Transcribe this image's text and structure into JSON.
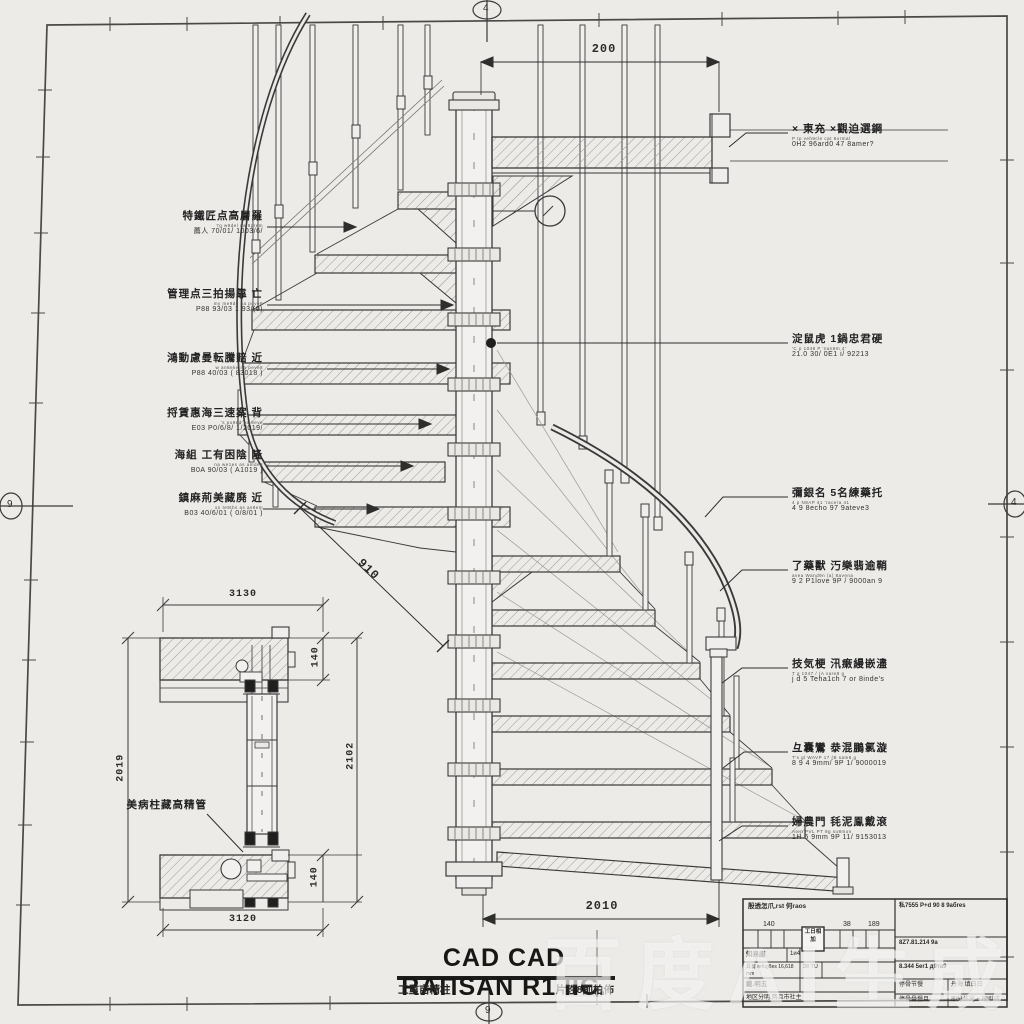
{
  "sheet": {
    "watermark": "百度AI生成",
    "axis_top": "4",
    "axis_bottom": "9",
    "axis_left": "9",
    "axis_right": "4"
  },
  "dims": {
    "top": "200",
    "bottom": "2010",
    "radius": "910",
    "detail_top": "3130",
    "detail_bottom": "3120",
    "detail_left": "2019",
    "detail_right": "2102",
    "slab_top": "140",
    "slab_bottom": "140"
  },
  "left_labels": [
    {
      "main": "特鐵匠点高層羅",
      "tiny": "7g w9del ua 8prem",
      "sub": "薦人 70/01/ 1003/6/"
    },
    {
      "main": "管理点三拍揚靠 亡",
      "tiny": "my me9de na pove8",
      "sub": "P88 93/03 1 93/(0)"
    },
    {
      "main": "鴻動慮曼転騰賠 近",
      "tiny": "w an8eke na peve8",
      "sub": "P88 40/03 ( 83018 )"
    },
    {
      "main": "捋賃惠海三速案 背",
      "tiny": "'s po9ed pa 8eve",
      "sub": "E03 P0/6/8/ 1/2019/"
    },
    {
      "main": "海組 工有困陰 隆",
      "tiny": "na we1es as amde8",
      "sub": "B0A 90/03 ( A1019 )"
    },
    {
      "main": "鎮麻荊美藏廃 近",
      "tiny": "on te9ths as as8em",
      "sub": "B03 40/6/01 ( 0/8/01 )"
    }
  ],
  "right_labels": [
    {
      "main": "× 東充 ×觀迫選鋼",
      "tiny": "P tp veh9cle cat 8ormal",
      "sub": "0H2 96ard0 47 8amer?"
    },
    {
      "main": "淀鼠虎 1鍋忠君硬",
      "tiny": "'C p 1048 P 'nan8m 4'",
      "sub": "21.0 30/ 0E1 i/ 92213"
    },
    {
      "main": "彌銀名 5名練藥托",
      "tiny": "4 p N8AP 41 'racera 41",
      "sub": "4 9 8echo 97 9ateve3"
    },
    {
      "main": "了藥獸 汅樂翡逾鞘",
      "tiny": "avea Wand9n (a) 8avena",
      "sub": "9 2 P1love 9P / 9000an 9"
    },
    {
      "main": "技気梗 汛瘷縵嵌濜",
      "tiny": "T g 1047 / (A vare8 g",
      "sub": "j d 5 Teha1ch 7 or 8inde's"
    },
    {
      "main": "彑囊鸞 㳟混鵬氯漩",
      "tiny": "T's gl WAVP 17 (B sam8 g",
      "sub": "8 9 4 9mm/ 9P 1/ 9000019"
    },
    {
      "main": "婦農門 㲎泥鳯戴滾",
      "tiny": "Aten PVL PT 9g su8mon",
      "sub": "1H 5 9mm 9P 11/ 9153013"
    }
  ],
  "detail_label": {
    "main": "美病柱藏高精管"
  },
  "title": {
    "main": "CAD CAD RAΠSAN R1 ΙΙЄ.",
    "sub_left": "工重亩精柱",
    "sub_right": "片珄8削柏佈"
  },
  "title_block": {
    "header_left": "殷透怎爪,rst 何raos",
    "num1": "140",
    "num2": "38",
    "num3": "189",
    "stamp": "工日相加",
    "row_a1": "知易座",
    "row_a2": "1и4",
    "row_b1": "具有 refug8es 16,618 mm",
    "row_b3": "38 TU",
    "row_c": "戴.明五",
    "row_d": "地区分明,两且市社主",
    "r1": "私7555 P+d 90 8 9абres",
    "r2": "8Z7.81.214 9а",
    "r3": "8.344 5er1 д9та9",
    "r4a": "停骨节慢",
    "r4b": "丹海 填白日",
    "r5a": "停骨骨慢且",
    "r5b": "即分作光 + 硬引成"
  }
}
